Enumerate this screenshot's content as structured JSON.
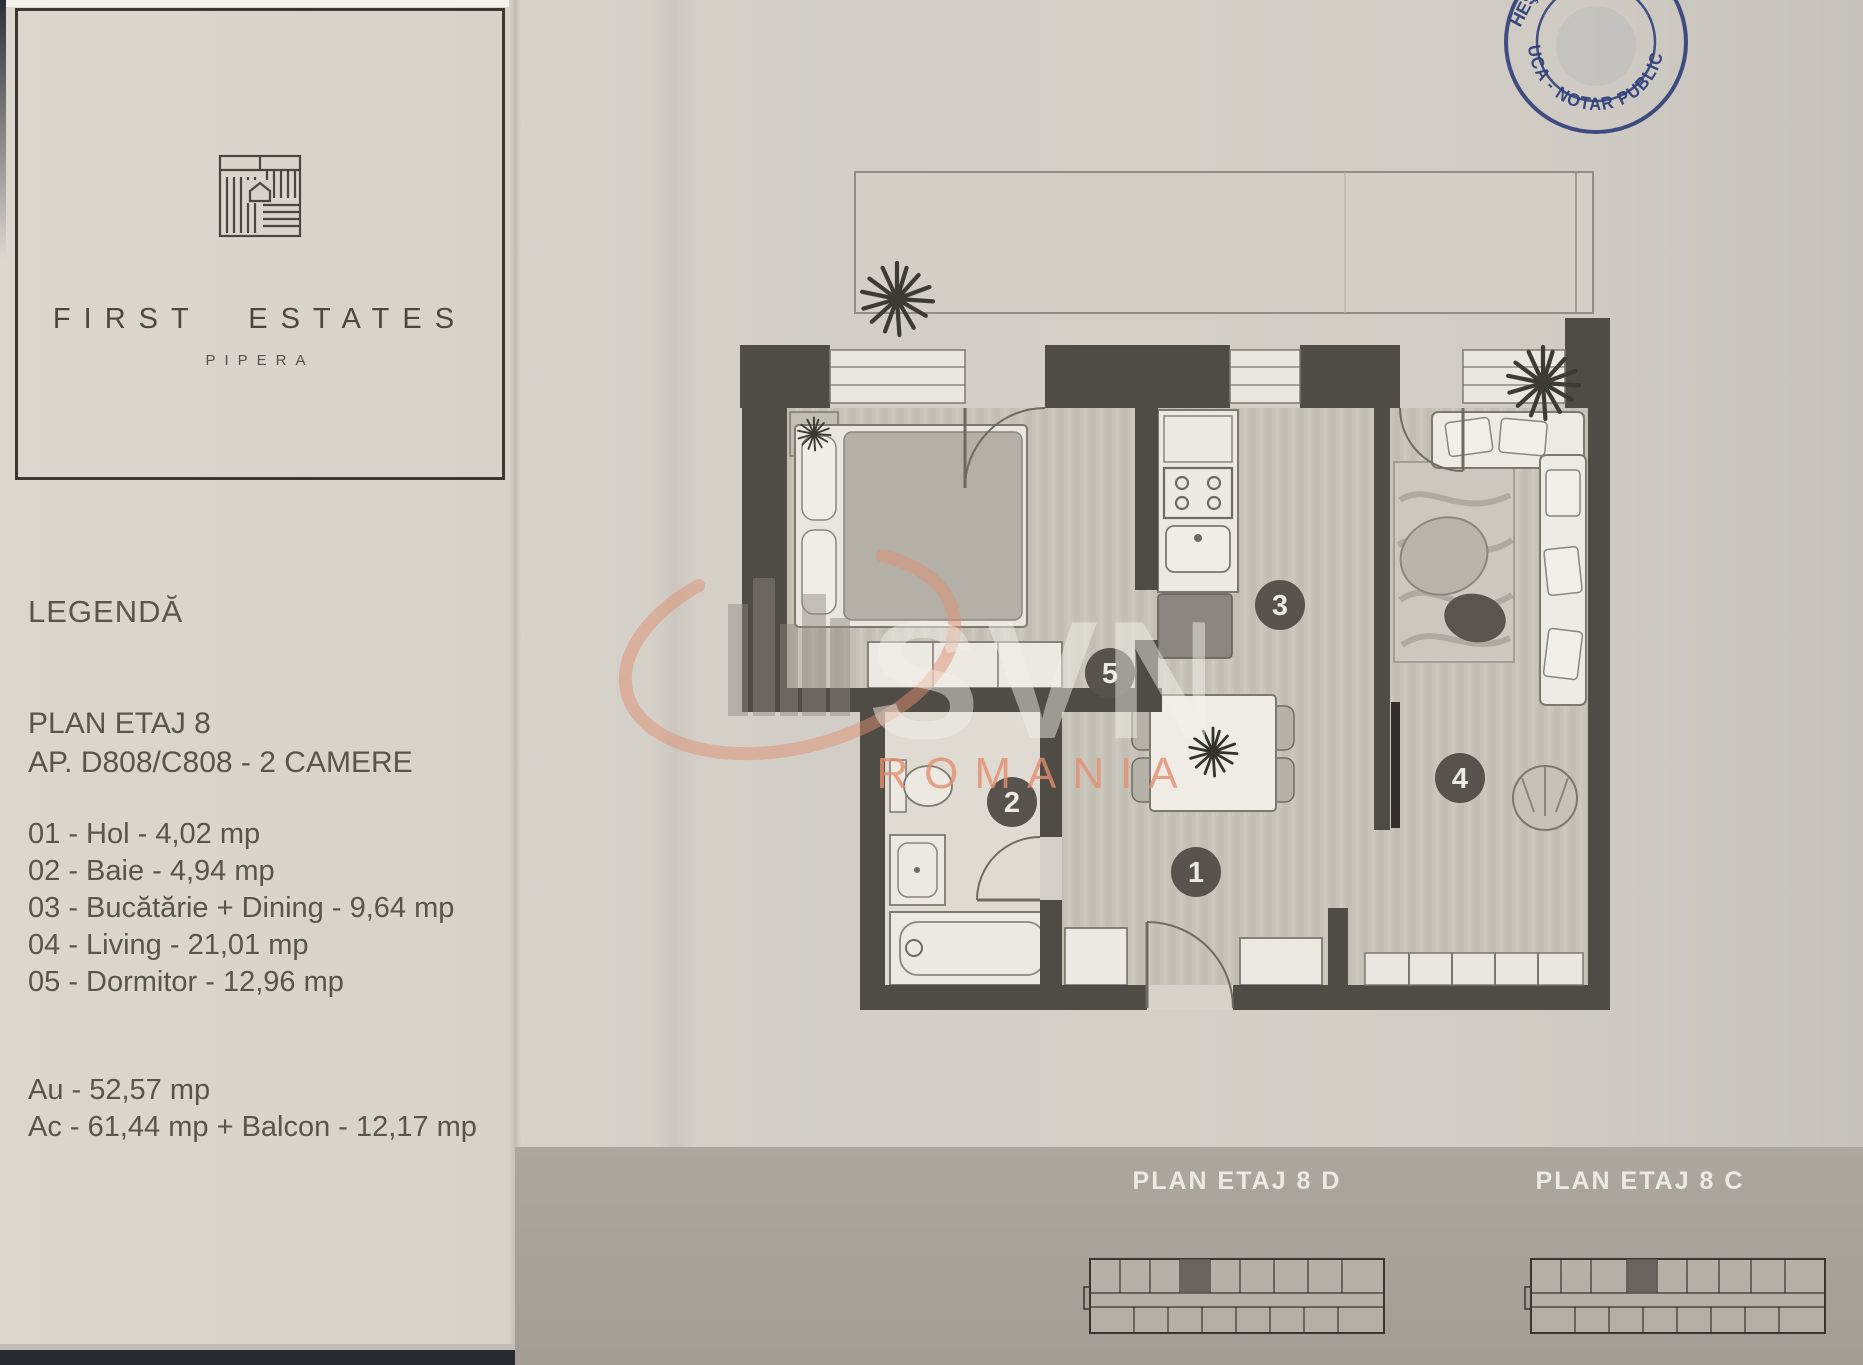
{
  "brand": {
    "name": "FIRST ESTATES",
    "subtitle": "PIPERA"
  },
  "legend": {
    "title": "LEGENDĂ",
    "plan_title": "PLAN ETAJ 8",
    "apartment_line": "AP. D808/C808 - 2 CAMERE",
    "rooms": [
      {
        "num": "01",
        "name": "Hol",
        "area": "4,02 mp",
        "display": "01 - Hol - 4,02 mp"
      },
      {
        "num": "02",
        "name": "Baie",
        "area": "4,94 mp",
        "display": "02 - Baie - 4,94 mp"
      },
      {
        "num": "03",
        "name": "Bucătărie + Dining",
        "area": "9,64 mp",
        "display": "03 - Bucătărie + Dining - 9,64 mp"
      },
      {
        "num": "04",
        "name": "Living",
        "area": "21,01 mp",
        "display": "04 - Living - 21,01 mp"
      },
      {
        "num": "05",
        "name": "Dormitor",
        "area": "12,96 mp",
        "display": "05 - Dormitor - 12,96 mp"
      }
    ],
    "area_lines": [
      "Au - 52,57 mp",
      "Ac - 61,44 mp + Balcon - 12,17 mp"
    ]
  },
  "plan": {
    "markers": [
      "1",
      "2",
      "3",
      "4",
      "5"
    ]
  },
  "mini_plans": [
    {
      "label": "PLAN ETAJ 8 D"
    },
    {
      "label": "PLAN ETAJ 8 C"
    }
  ],
  "stamp": {
    "arc_text": "UCA - NOTAR PUBLIC",
    "side_text": "HEŞTI"
  },
  "watermark": {
    "name": "SVN",
    "subtitle": "ROMANIA"
  },
  "colors": {
    "paper": "#d6d2ca",
    "wall": "#4f4b45",
    "stamp_blue": "#31417a",
    "watermark_orange": "#dd8f6f",
    "band": "#a8a39b"
  }
}
